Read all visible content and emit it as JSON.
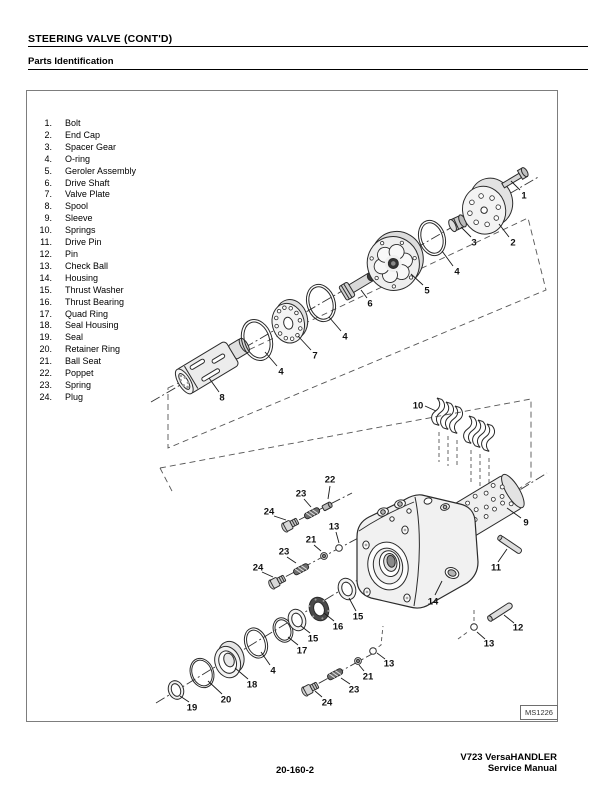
{
  "header": {
    "section_title": "STEERING VALVE (CONT'D)",
    "subsection_title": "Parts Identification"
  },
  "figure": {
    "id_label": "MS1226"
  },
  "parts_list": [
    {
      "num": "1.",
      "name": "Bolt"
    },
    {
      "num": "2.",
      "name": "End Cap"
    },
    {
      "num": "3.",
      "name": "Spacer Gear"
    },
    {
      "num": "4.",
      "name": "O-ring"
    },
    {
      "num": "5.",
      "name": "Geroler Assembly"
    },
    {
      "num": "6.",
      "name": "Drive Shaft"
    },
    {
      "num": "7.",
      "name": "Valve Plate"
    },
    {
      "num": "8.",
      "name": "Spool"
    },
    {
      "num": "9.",
      "name": "Sleeve"
    },
    {
      "num": "10.",
      "name": "Springs"
    },
    {
      "num": "11.",
      "name": "Drive Pin"
    },
    {
      "num": "12.",
      "name": "Pin"
    },
    {
      "num": "13.",
      "name": "Check Ball"
    },
    {
      "num": "14.",
      "name": "Housing"
    },
    {
      "num": "15.",
      "name": "Thrust Washer"
    },
    {
      "num": "16.",
      "name": "Thrust Bearing"
    },
    {
      "num": "17.",
      "name": "Quad Ring"
    },
    {
      "num": "18.",
      "name": "Seal Housing"
    },
    {
      "num": "19.",
      "name": "Seal"
    },
    {
      "num": "20.",
      "name": "Retainer Ring"
    },
    {
      "num": "21.",
      "name": "Ball Seat"
    },
    {
      "num": "22.",
      "name": "Poppet"
    },
    {
      "num": "23.",
      "name": "Spring"
    },
    {
      "num": "24.",
      "name": "Plug"
    }
  ],
  "callouts": [
    {
      "n": "1",
      "x": 524,
      "y": 196,
      "l": [
        520,
        190,
        511,
        181
      ]
    },
    {
      "n": "2",
      "x": 513,
      "y": 243,
      "l": [
        509,
        237,
        499,
        224
      ]
    },
    {
      "n": "3",
      "x": 474,
      "y": 243,
      "l": [
        471,
        237,
        461,
        227
      ]
    },
    {
      "n": "4",
      "x": 457,
      "y": 272,
      "l": [
        453,
        266,
        442,
        251
      ]
    },
    {
      "n": "5",
      "x": 427,
      "y": 291,
      "l": [
        423,
        285,
        411,
        274
      ]
    },
    {
      "n": "6",
      "x": 370,
      "y": 304,
      "l": [
        367,
        298,
        361,
        290
      ]
    },
    {
      "n": "4",
      "x": 345,
      "y": 337,
      "l": [
        341,
        331,
        329,
        317
      ]
    },
    {
      "n": "7",
      "x": 315,
      "y": 356,
      "l": [
        311,
        350,
        298,
        336
      ]
    },
    {
      "n": "4",
      "x": 281,
      "y": 372,
      "l": [
        277,
        366,
        265,
        352
      ]
    },
    {
      "n": "8",
      "x": 222,
      "y": 398,
      "l": [
        219,
        392,
        209,
        378
      ]
    },
    {
      "n": "10",
      "x": 418,
      "y": 406,
      "l": [
        425,
        406,
        436,
        411
      ]
    },
    {
      "n": "9",
      "x": 526,
      "y": 523,
      "l": [
        521,
        518,
        507,
        508
      ]
    },
    {
      "n": "11",
      "x": 496,
      "y": 568,
      "l": [
        498,
        562,
        507,
        549
      ]
    },
    {
      "n": "14",
      "x": 433,
      "y": 602,
      "l": [
        435,
        595,
        442,
        581
      ]
    },
    {
      "n": "12",
      "x": 518,
      "y": 628,
      "l": [
        514,
        623,
        504,
        615
      ]
    },
    {
      "n": "13",
      "x": 489,
      "y": 644,
      "l": [
        485,
        639,
        477,
        632
      ]
    },
    {
      "n": "22",
      "x": 330,
      "y": 480,
      "l": [
        330,
        486,
        328,
        499
      ]
    },
    {
      "n": "23",
      "x": 301,
      "y": 494,
      "l": [
        304,
        499,
        311,
        507
      ]
    },
    {
      "n": "24",
      "x": 269,
      "y": 512,
      "l": [
        274,
        516,
        286,
        520
      ]
    },
    {
      "n": "13",
      "x": 334,
      "y": 527,
      "l": [
        336,
        532,
        339,
        543
      ]
    },
    {
      "n": "21",
      "x": 311,
      "y": 540,
      "l": [
        314,
        545,
        321,
        551
      ]
    },
    {
      "n": "23",
      "x": 284,
      "y": 552,
      "l": [
        287,
        557,
        296,
        563
      ]
    },
    {
      "n": "24",
      "x": 258,
      "y": 568,
      "l": [
        262,
        572,
        273,
        577
      ]
    },
    {
      "n": "15",
      "x": 358,
      "y": 617,
      "l": [
        356,
        611,
        349,
        598
      ]
    },
    {
      "n": "16",
      "x": 338,
      "y": 627,
      "l": [
        334,
        621,
        324,
        613
      ]
    },
    {
      "n": "15",
      "x": 313,
      "y": 639,
      "l": [
        310,
        633,
        301,
        626
      ]
    },
    {
      "n": "17",
      "x": 302,
      "y": 651,
      "l": [
        298,
        645,
        288,
        637
      ]
    },
    {
      "n": "4",
      "x": 273,
      "y": 671,
      "l": [
        270,
        665,
        261,
        652
      ]
    },
    {
      "n": "18",
      "x": 252,
      "y": 685,
      "l": [
        248,
        679,
        235,
        668
      ]
    },
    {
      "n": "20",
      "x": 226,
      "y": 700,
      "l": [
        222,
        694,
        208,
        681
      ]
    },
    {
      "n": "19",
      "x": 192,
      "y": 708,
      "l": [
        189,
        702,
        180,
        696
      ]
    },
    {
      "n": "13",
      "x": 389,
      "y": 664,
      "l": [
        385,
        659,
        377,
        653
      ]
    },
    {
      "n": "21",
      "x": 368,
      "y": 677,
      "l": [
        364,
        671,
        359,
        665
      ]
    },
    {
      "n": "23",
      "x": 354,
      "y": 690,
      "l": [
        350,
        684,
        341,
        678
      ]
    },
    {
      "n": "24",
      "x": 327,
      "y": 703,
      "l": [
        322,
        697,
        315,
        691
      ]
    }
  ],
  "footer": {
    "page_number": "20-160-2",
    "doc_title_line1": "V723 VersaHANDLER",
    "doc_title_line2": "Service Manual"
  }
}
